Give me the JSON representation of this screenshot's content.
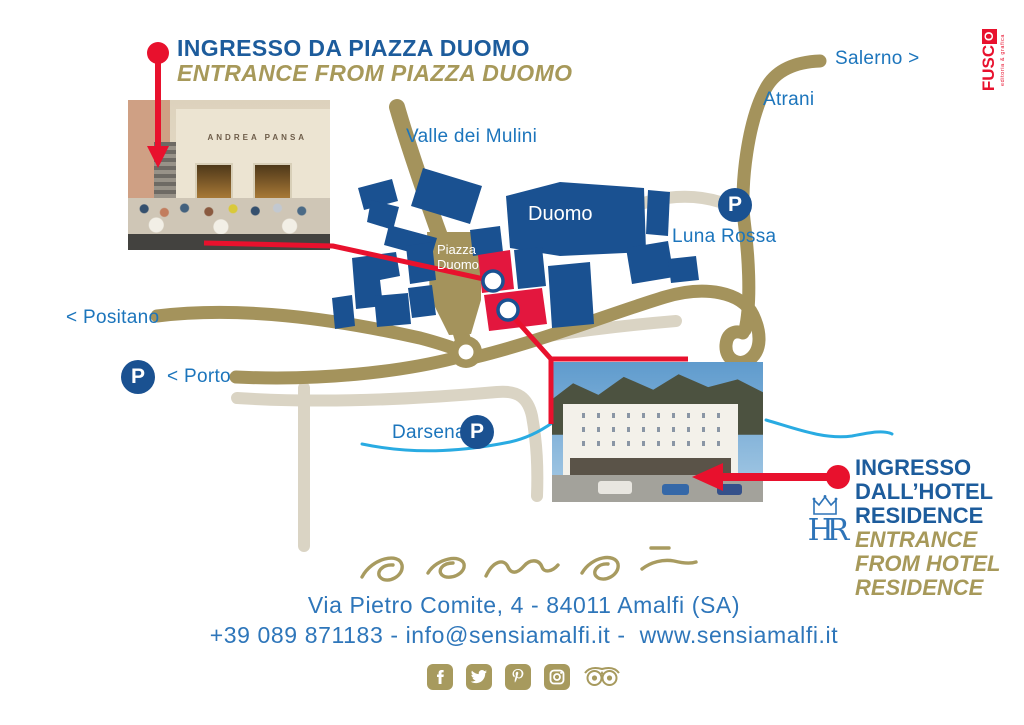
{
  "entrance_piazza": {
    "title": "INGRESSO DA PIAZZA DUOMO",
    "subtitle": "ENTRANCE FROM PIAZZA DUOMO"
  },
  "entrance_hotel": {
    "title_line1": "INGRESSO",
    "title_line2": "DALL’HOTEL",
    "title_line3": "RESIDENCE",
    "subtitle_line1": "ENTRANCE",
    "subtitle_line2": "FROM HOTEL",
    "subtitle_line3": "RESIDENCE",
    "logo_text": "HR"
  },
  "map": {
    "labels": {
      "valle": "Valle dei Mulini",
      "duomo": "Duomo",
      "piazza_line1": "Piazza",
      "piazza_line2": "Duomo",
      "atrani": "Atrani",
      "salerno": "Salerno >",
      "luna_rossa": "Luna Rossa",
      "positano": "< Positano",
      "porto": "< Porto",
      "darsena": "Darsena"
    },
    "parking_symbol": "P"
  },
  "photos": {
    "cafe_sign": "ANDREA PANSA"
  },
  "footer": {
    "brand": "sensi",
    "address": "Via Pietro Comite, 4 - 84011 Amalfi (SA)",
    "contact": "+39 089 871183 - info@sensiamalfi.it -  www.sensiamalfi.it",
    "social": [
      "facebook",
      "twitter",
      "pinterest",
      "instagram",
      "tripadvisor"
    ]
  },
  "fusco": {
    "name_start": "FUSC",
    "name_end": "O",
    "tagline": "editoria & grafica"
  },
  "colors": {
    "heading_blue": "#1D5C9C",
    "label_blue": "#1C75BC",
    "building_navy": "#1A5191",
    "gold": "#A7995A",
    "road_olive": "#A4935C",
    "road_light": "#DAD4C4",
    "red": "#E8112D",
    "water": "#29ABE2"
  }
}
